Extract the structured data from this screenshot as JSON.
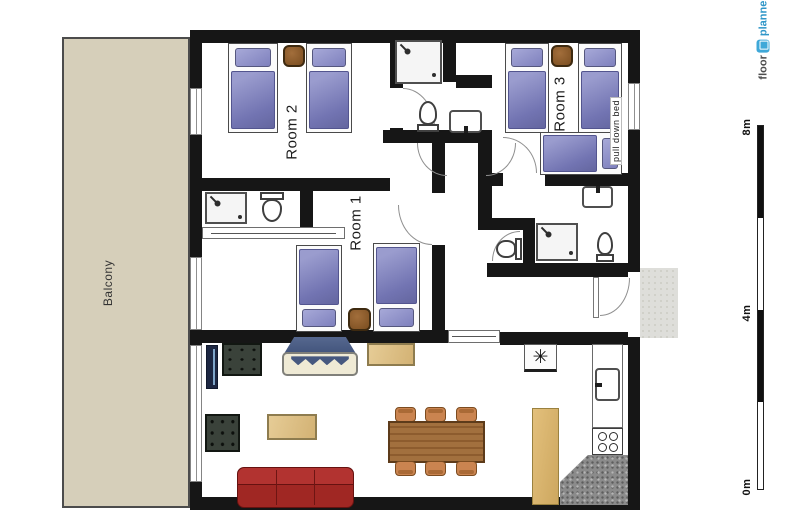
{
  "branding": {
    "logo_floor": "floor",
    "logo_planner": "planner"
  },
  "labels": {
    "room1": "Room 1",
    "room2": "Room 2",
    "room3": "Room 3",
    "balcony": "Balcony",
    "pull_down_bed": "pull down bed"
  },
  "scale_bar": {
    "top": "8m",
    "middle": "4m",
    "bottom": "0m"
  },
  "kitchen": {
    "freezer_symbol": "✳"
  },
  "colors": {
    "wall": "#161616",
    "balcony_fill": "#d6cfba",
    "bed_purple": "#8486c0",
    "nightstand_brown": "#8b5a2b",
    "sofa_red": "#a02723",
    "armchair_green": "#3a423a",
    "dining_table_brown": "#996a3d",
    "chair_tan": "#ca8450",
    "light_wood": "#d9b977",
    "counter_gray": "#8b8b8b",
    "logo_blue": "#2f96c8"
  }
}
